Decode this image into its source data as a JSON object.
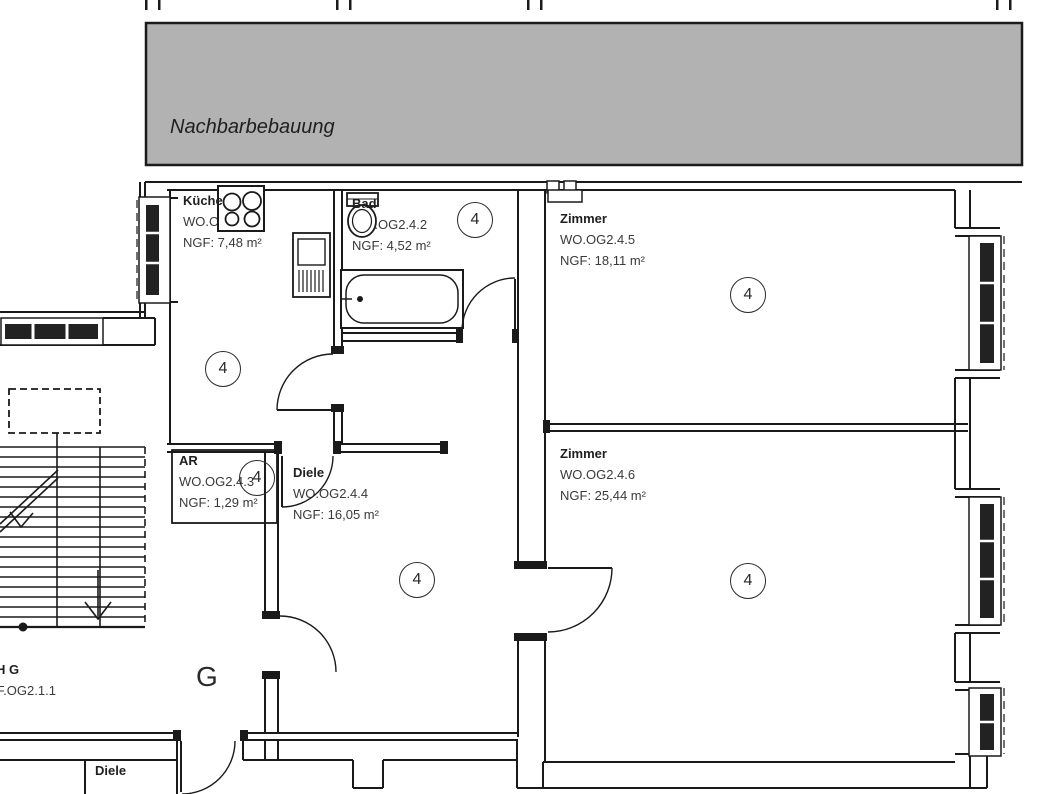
{
  "plan": {
    "neighbor_label": "Nachbarbebauung",
    "marker": "4",
    "rooms": [
      {
        "name": "Küche",
        "code": "WO.OG2.4.1",
        "area": "NGF: 7,48 m²"
      },
      {
        "name": "Bad",
        "code": "WO.OG2.4.2",
        "area": "NGF: 4,52 m²"
      },
      {
        "name": "AR",
        "code": "WO.OG2.4.3",
        "area": "NGF: 1,29 m²"
      },
      {
        "name": "Diele",
        "code": "WO.OG2.4.4",
        "area": "NGF: 16,05 m²"
      },
      {
        "name": "Zimmer",
        "code": "WO.OG2.4.5",
        "area": "NGF: 18,11 m²"
      },
      {
        "name": "Zimmer",
        "code": "WO.OG2.4.6",
        "area": "NGF: 25,44 m²"
      }
    ],
    "stair_hall": {
      "name": "TH G",
      "code": "VF.OG2.1.1",
      "letter": "G"
    },
    "lower_room": {
      "name": "Diele"
    },
    "colors": {
      "wall_line": "#1a1a1a",
      "neighbor_fill": "#b2b2b2",
      "window_glass": "#222222"
    }
  }
}
